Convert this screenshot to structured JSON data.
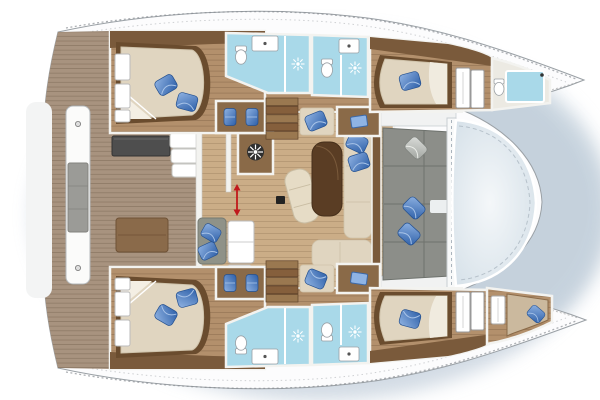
{
  "meta": {
    "type": "floorplan-diagram",
    "subject": "Catamaran sailing yacht interior layout, top-down plan view, bow pointing right",
    "canvas": {
      "width": 600,
      "height": 400
    },
    "visible_text": []
  },
  "colors": {
    "page_bg": "#ffffff",
    "hull_shadow": "#c3cfdb",
    "deck_white": "#fcfcfd",
    "outline_gray": "#9aa0a5",
    "wall_white": "#f3f3f0",
    "cabin_wood": "#b3906c",
    "salon_wood": "#cbad87",
    "teak_deck": "#a8937f",
    "dark_wood": "#6a4c2e",
    "mid_wood": "#8a6a48",
    "mattress_cream": "#e0d5c0",
    "pillow_blue": "#4f7fc4",
    "pillow_blue_dark": "#2d5fa8",
    "bath_floor_blue": "#a9d9e9",
    "cushion_gray": "#8c8e89",
    "trampoline_light": "#f4f7f9",
    "trampoline_edge": "#d6e1e9",
    "arrow_red": "#c0181c",
    "table_dark": "#4e4e4e"
  },
  "layout": {
    "stern_cockpit": {
      "position": "left",
      "items": [
        "swim-platform",
        "stern-bench-with-gray-cushion",
        "dark-outdoor-table",
        "wooden-cockpit-bench",
        "teak-deck",
        "outdoor-galley-counters"
      ]
    },
    "salon": {
      "position": "center-bridgedeck",
      "items": [
        "galley-wall",
        "entry-marked-by-red-double-arrow",
        "helm-cabinet-with-ship-wheel",
        "chaise-longue",
        "dining-table",
        "l-shaped-sofa-with-blue-pillows",
        "gray-bench-with-blue-pillows",
        "fridge-unit",
        "small-black-box"
      ]
    },
    "port_hull": {
      "position": "top",
      "rooms": [
        "aft-double-cabin-with-island-bed",
        "ensuite-bathroom-with-shower",
        "second-bathroom-with-shower",
        "vanity-desk-with-two-stools",
        "companionway-stairs",
        "seat-and-side-table",
        "forward-double-cabin",
        "wardrobe",
        "bow-bathroom-with-shower"
      ]
    },
    "starboard_hull": {
      "position": "bottom",
      "note": "mirror image of port hull",
      "rooms": [
        "aft-double-cabin-with-island-bed",
        "ensuite-bathroom-with-shower",
        "second-bathroom-with-shower",
        "vanity-desk-with-two-stools",
        "companionway-stairs",
        "seat-and-side-table",
        "forward-double-cabin",
        "wardrobe",
        "bow-single-berth"
      ]
    },
    "foredeck": {
      "position": "right",
      "items": [
        "forward-cockpit-gray-sofa-with-pillows",
        "white-crossbeam",
        "trampoline-sunpad"
      ]
    }
  },
  "counts": {
    "double_cabins": 4,
    "bathrooms": 5,
    "shower_sun_symbols": 4,
    "toilets": 5,
    "vanity_stools": 4,
    "blue_pillows": 15,
    "stairways": 2
  },
  "icons": {
    "helm_wheel_icon": "ship steering wheel",
    "shower_rose_icon": "sun-ray shower symbol on blue floor",
    "toilet_icon": "toilet with tank, top view",
    "sink_icon": "white washbasin counter with drain dot",
    "blue_pillow_icon": "blue decorative pillow",
    "gray_pillow_icon": "gray decorative pillow",
    "companionway_arrow_icon": "red vertical double-headed arrow at salon entry",
    "screw_dot_icon": "round deck fitting"
  }
}
